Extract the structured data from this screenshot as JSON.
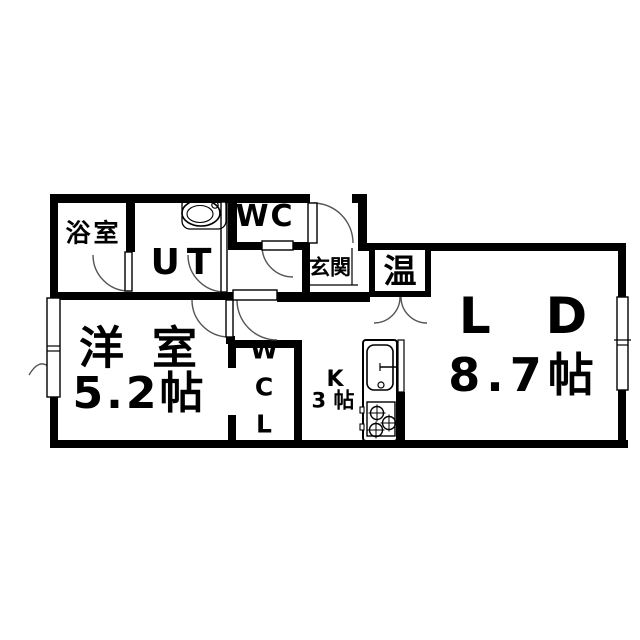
{
  "floorplan": {
    "type": "apartment-floor-plan",
    "colors": {
      "line": "#000000",
      "background": "#ffffff"
    },
    "rooms": {
      "bathroom": {
        "label": "浴室"
      },
      "utility": {
        "label": "UT"
      },
      "toilet": {
        "label": "WC"
      },
      "entrance": {
        "label": "玄関"
      },
      "water_heater": {
        "label": "温"
      },
      "living_dining": {
        "label": "LD",
        "area": "8.7帖"
      },
      "western_room": {
        "label": "洋室",
        "area": "5.2帖"
      },
      "walk_in_closet": {
        "label": "WCL"
      },
      "kitchen": {
        "label": "K",
        "area": "3 帖"
      }
    },
    "fixtures": [
      "vanity-sink",
      "kitchen-sink",
      "gas-stove",
      "water-heater-cabinet",
      "entrance-door",
      "sliding-windows"
    ]
  }
}
